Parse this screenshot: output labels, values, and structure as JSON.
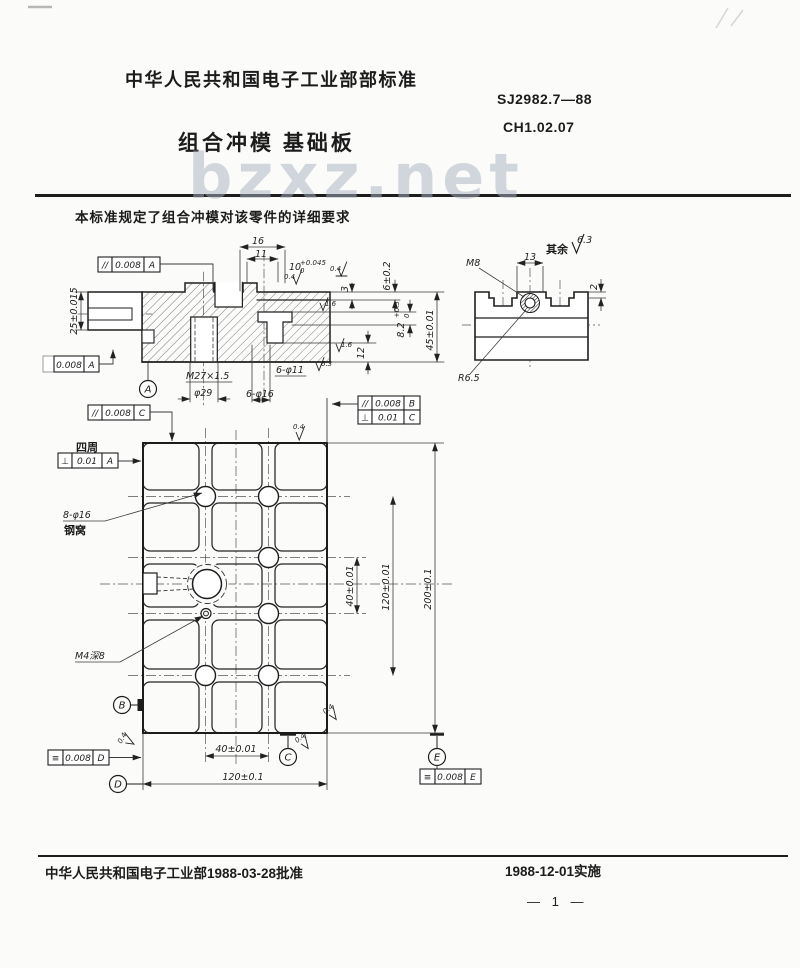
{
  "header": {
    "org": "中华人民共和国电子工业部部标准",
    "std_no": "SJ2982.7—88",
    "class_no": "CH1.02.07",
    "title": "组合冲模  基础板",
    "watermark": "bzxz.net",
    "scope": "本标准规定了组合冲模对该零件的详细要求"
  },
  "footer": {
    "approved": "中华人民共和国电子工业部1988-03-28批准",
    "implemented": "1988-12-01实施",
    "page_no": "— 1 —"
  },
  "section": {
    "frame_top": {
      "sym": "//",
      "tol": "0.008",
      "datum": "A"
    },
    "frame_left": {
      "tol": "0.008",
      "datum": "A"
    },
    "dim16": "16",
    "dim11": "11",
    "dim10": "10",
    "dim10_sup": "+0.045",
    "dim10_sub": "0",
    "dim25": "25±0.015",
    "dim3": "3",
    "dim6": "6±0.2",
    "dim82": "8.2",
    "dim82_sup": "+0.3",
    "dim82_sub": "0",
    "dim12": "12",
    "dim45": "45±0.01",
    "thread": "M27×1.5",
    "bore": "φ29",
    "holes11": "6-φ11",
    "holes16": "6-φ16",
    "datum_a": "A",
    "f04a": "0.4",
    "f04b": "0.4",
    "f16a": "1.6",
    "f16b": "1.6",
    "f63": "6.3"
  },
  "tslot": {
    "rest_label": "其余",
    "rest_value": "6.3",
    "m8": "M8",
    "dim13": "13",
    "dim2": "2",
    "r": "R6.5"
  },
  "plan": {
    "frame_c": {
      "sym": "//",
      "tol": "0.008",
      "datum": "C"
    },
    "frame_b1": {
      "sym": "//",
      "tol": "0.008",
      "datum": "B"
    },
    "frame_b2": {
      "sym": "⊥",
      "tol": "0.01",
      "datum": "C"
    },
    "frame_a": {
      "sym": "⊥",
      "tol": "0.01",
      "datum": "A",
      "note": "四周"
    },
    "frame_d": {
      "sym": "≡",
      "tol": "0.008",
      "datum": "D"
    },
    "frame_e": {
      "sym": "≡",
      "tol": "0.008",
      "datum": "E"
    },
    "holes_label": "8-φ16",
    "holes_label2": "钢窝",
    "m4_label": "M4深8",
    "dim_v40": "40±0.01",
    "dim_v120": "120±0.01",
    "dim_v200": "200±0.1",
    "dim_b40": "40±0.01",
    "dim_b120": "120±0.1",
    "datum_b": "B",
    "datum_c": "C",
    "datum_d": "D",
    "datum_e": "E",
    "f04_top": "0.4",
    "f04_left": "0.4",
    "f04_c1": "0.4",
    "f04_c2": "0.4"
  }
}
